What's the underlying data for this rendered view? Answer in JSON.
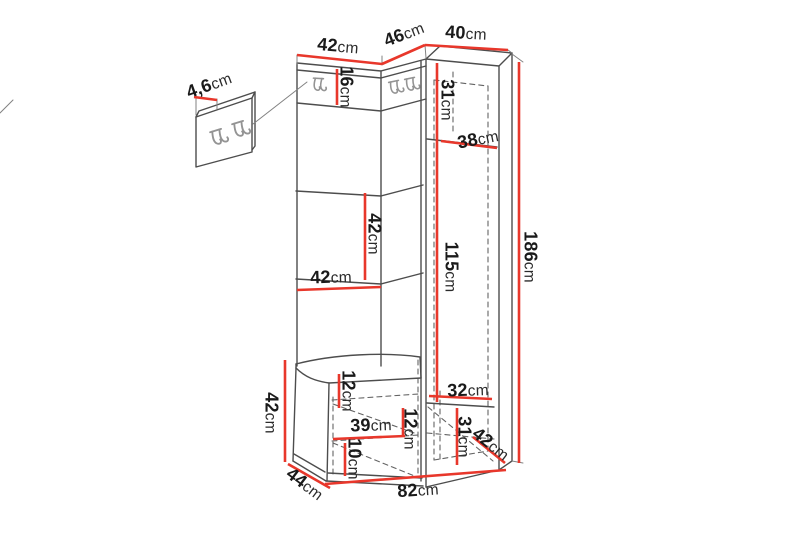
{
  "colors": {
    "background": "#ffffff",
    "dimension": "#e8372b",
    "outline": "#4d4d4d",
    "hook": "#949494",
    "text": "#1a1a1a"
  },
  "labels": {
    "wall_panel_thickness": {
      "num": "4,6",
      "unit": "cm"
    },
    "left_panel_width": {
      "num": "42",
      "unit": "cm"
    },
    "corner_panel_width": {
      "num": "46",
      "unit": "cm"
    },
    "cabinet_width": {
      "num": "40",
      "unit": "cm"
    },
    "hook_strip_height": {
      "num": "16",
      "unit": "cm"
    },
    "cabinet_top_section_height": {
      "num": "31",
      "unit": "cm"
    },
    "cabinet_shelf_depth": {
      "num": "38",
      "unit": "cm"
    },
    "panel_section_height": {
      "num": "42",
      "unit": "cm"
    },
    "panel_section_width": {
      "num": "42",
      "unit": "cm"
    },
    "door_section_height": {
      "num": "115",
      "unit": "cm"
    },
    "total_height": {
      "num": "186",
      "unit": "cm"
    },
    "bench_height": {
      "num": "42",
      "unit": "cm"
    },
    "bench_top_clearance": {
      "num": "12",
      "unit": "cm"
    },
    "bench_inner_width": {
      "num": "39",
      "unit": "cm"
    },
    "bench_shelf_spacing": {
      "num": "12",
      "unit": "cm"
    },
    "bench_bottom_clearance": {
      "num": "10",
      "unit": "cm"
    },
    "bench_depth": {
      "num": "44",
      "unit": "cm"
    },
    "cabinet_bottom_section_width": {
      "num": "32",
      "unit": "cm"
    },
    "cabinet_bottom_section_height": {
      "num": "31",
      "unit": "cm"
    },
    "cabinet_depth": {
      "num": "42",
      "unit": "cm"
    },
    "total_width": {
      "num": "82",
      "unit": "cm"
    }
  }
}
